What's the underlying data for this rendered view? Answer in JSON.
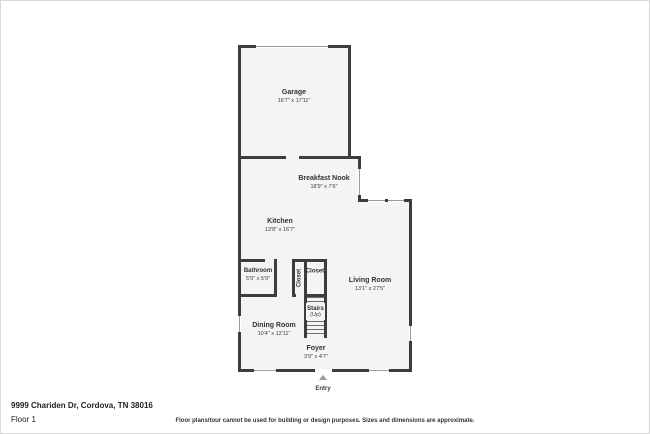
{
  "plan": {
    "rooms": [
      {
        "id": "garage",
        "name": "Garage",
        "dims": "16'7\" x 17'11\""
      },
      {
        "id": "breakfast-nook",
        "name": "Breakfast Nook",
        "dims": "18'9\" x 7'6\""
      },
      {
        "id": "kitchen",
        "name": "Kitchen",
        "dims": "13'8\" x 16'7\""
      },
      {
        "id": "bathroom",
        "name": "Bathroom",
        "dims": "5'5\" x 5'9\""
      },
      {
        "id": "closet-side",
        "name": "Closet",
        "dims": ""
      },
      {
        "id": "closet",
        "name": "Closet",
        "dims": ""
      },
      {
        "id": "living-room",
        "name": "Living Room",
        "dims": "13'1\" x 27'5\""
      },
      {
        "id": "stairs",
        "name": "Stairs",
        "dims": "(Up)"
      },
      {
        "id": "dining-room",
        "name": "Dining Room",
        "dims": "10'4\" x 12'11\""
      },
      {
        "id": "foyer",
        "name": "Foyer",
        "dims": "3'9\" x 4'7\""
      }
    ],
    "entry_label": "Entry"
  },
  "footer": {
    "address": "9999 Chariden Dr, Cordova, TN 38016",
    "floor_label": "Floor 1",
    "disclaimer": "Floor plans/tour cannot be used for building or design purposes. Sizes and dimensions are approximate."
  },
  "colors": {
    "wall": "#3d3d3d",
    "floor": "#f4f4f4",
    "background": "#ffffff"
  }
}
